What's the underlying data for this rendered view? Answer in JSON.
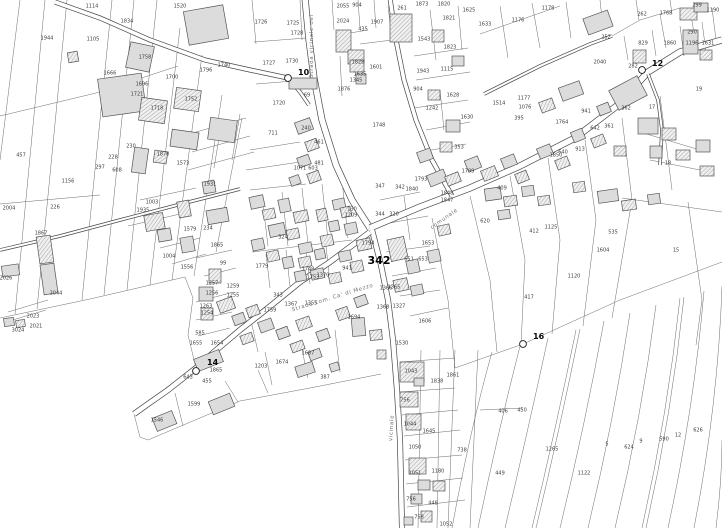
{
  "map": {
    "type": "cadastral-parcel-map",
    "colors": {
      "background": "#ffffff",
      "parcel_line": "#6b6b6b",
      "road_edge": "#474747",
      "building_fill": "#dcdcdc",
      "building_stroke": "#555555",
      "hatch_line": "#929292",
      "label_text": "#3d3d3d",
      "street_text": "#6f6f6f",
      "point_text": "#0a0a0a"
    },
    "highlight_parcel": {
      "label": "342",
      "x": 379,
      "y": 261
    },
    "survey_points": [
      {
        "id": "10",
        "x": 288,
        "y": 78,
        "lx": 298,
        "ly": 75
      },
      {
        "id": "12",
        "x": 642,
        "y": 70,
        "lx": 652,
        "ly": 66
      },
      {
        "id": "14",
        "x": 196,
        "y": 371,
        "lx": 207,
        "ly": 365
      },
      {
        "id": "16",
        "x": 523,
        "y": 344,
        "lx": 533,
        "ly": 339
      }
    ],
    "street_labels": [
      {
        "text": "Strada vicinale del",
        "x": 313,
        "y": 46,
        "rotation": -90
      },
      {
        "text": "Strada com. Ca' di Mezzo",
        "x": 333,
        "y": 299,
        "rotation": -17
      },
      {
        "text": "comunale",
        "x": 445,
        "y": 220,
        "rotation": -35
      },
      {
        "text": "vicinale",
        "x": 393,
        "y": 428,
        "rotation": -87
      }
    ],
    "parcel_labels": [
      {
        "t": "1114",
        "x": 92,
        "y": 6
      },
      {
        "t": "1834",
        "x": 127,
        "y": 21
      },
      {
        "t": "1944",
        "x": 47,
        "y": 38
      },
      {
        "t": "1105",
        "x": 93,
        "y": 39
      },
      {
        "t": "1520",
        "x": 180,
        "y": 6
      },
      {
        "t": "1758",
        "x": 145,
        "y": 57
      },
      {
        "t": "1666",
        "x": 110,
        "y": 73
      },
      {
        "t": "1700",
        "x": 172,
        "y": 77
      },
      {
        "t": "1696",
        "x": 142,
        "y": 84
      },
      {
        "t": "1721",
        "x": 137,
        "y": 94
      },
      {
        "t": "1740",
        "x": 224,
        "y": 65
      },
      {
        "t": "1796",
        "x": 206,
        "y": 70
      },
      {
        "t": "1718",
        "x": 157,
        "y": 108
      },
      {
        "t": "1752",
        "x": 191,
        "y": 99
      },
      {
        "t": "230",
        "x": 131,
        "y": 146
      },
      {
        "t": "228",
        "x": 113,
        "y": 157
      },
      {
        "t": "297",
        "x": 100,
        "y": 167
      },
      {
        "t": "608",
        "x": 117,
        "y": 170
      },
      {
        "t": "457",
        "x": 21,
        "y": 155
      },
      {
        "t": "1573",
        "x": 183,
        "y": 163
      },
      {
        "t": "1878",
        "x": 163,
        "y": 154
      },
      {
        "t": "1156",
        "x": 68,
        "y": 181
      },
      {
        "t": "226",
        "x": 55,
        "y": 207
      },
      {
        "t": "2004",
        "x": 9,
        "y": 208
      },
      {
        "t": "1867",
        "x": 41,
        "y": 233
      },
      {
        "t": "2026",
        "x": 6,
        "y": 278
      },
      {
        "t": "2044",
        "x": 56,
        "y": 293
      },
      {
        "t": "2023",
        "x": 33,
        "y": 316
      },
      {
        "t": "2021",
        "x": 36,
        "y": 326
      },
      {
        "t": "3024",
        "x": 18,
        "y": 330
      },
      {
        "t": "1003",
        "x": 152,
        "y": 202
      },
      {
        "t": "1935",
        "x": 143,
        "y": 210
      },
      {
        "t": "1931",
        "x": 210,
        "y": 184
      },
      {
        "t": "1579",
        "x": 190,
        "y": 229
      },
      {
        "t": "234",
        "x": 208,
        "y": 228
      },
      {
        "t": "1004",
        "x": 169,
        "y": 256
      },
      {
        "t": "1556",
        "x": 187,
        "y": 267
      },
      {
        "t": "1865",
        "x": 217,
        "y": 245
      },
      {
        "t": "99",
        "x": 223,
        "y": 263
      },
      {
        "t": "1257",
        "x": 212,
        "y": 283
      },
      {
        "t": "1256",
        "x": 212,
        "y": 293
      },
      {
        "t": "1263",
        "x": 206,
        "y": 306
      },
      {
        "t": "1254",
        "x": 207,
        "y": 313
      },
      {
        "t": "1259",
        "x": 233,
        "y": 286
      },
      {
        "t": "1255",
        "x": 233,
        "y": 295
      },
      {
        "t": "585",
        "x": 200,
        "y": 333
      },
      {
        "t": "1655",
        "x": 196,
        "y": 343
      },
      {
        "t": "1654",
        "x": 217,
        "y": 343
      },
      {
        "t": "1726",
        "x": 261,
        "y": 22
      },
      {
        "t": "1725",
        "x": 293,
        "y": 23
      },
      {
        "t": "1728",
        "x": 297,
        "y": 33
      },
      {
        "t": "1727",
        "x": 269,
        "y": 63
      },
      {
        "t": "1730",
        "x": 292,
        "y": 61
      },
      {
        "t": "1720",
        "x": 279,
        "y": 103
      },
      {
        "t": "69",
        "x": 307,
        "y": 95
      },
      {
        "t": "240",
        "x": 306,
        "y": 128
      },
      {
        "t": "711",
        "x": 273,
        "y": 133
      },
      {
        "t": "2055",
        "x": 343,
        "y": 6
      },
      {
        "t": "2024",
        "x": 343,
        "y": 21
      },
      {
        "t": "904",
        "x": 357,
        "y": 5
      },
      {
        "t": "1907",
        "x": 377,
        "y": 22
      },
      {
        "t": "435",
        "x": 363,
        "y": 29
      },
      {
        "t": "1828",
        "x": 358,
        "y": 62
      },
      {
        "t": "1635",
        "x": 360,
        "y": 74
      },
      {
        "t": "1601",
        "x": 376,
        "y": 67
      },
      {
        "t": "1345",
        "x": 356,
        "y": 80
      },
      {
        "t": "1876",
        "x": 344,
        "y": 89
      },
      {
        "t": "1748",
        "x": 379,
        "y": 125
      },
      {
        "t": "261",
        "x": 402,
        "y": 8
      },
      {
        "t": "1873",
        "x": 422,
        "y": 4
      },
      {
        "t": "1820",
        "x": 444,
        "y": 4
      },
      {
        "t": "1821",
        "x": 449,
        "y": 18
      },
      {
        "t": "1625",
        "x": 469,
        "y": 10
      },
      {
        "t": "1543",
        "x": 424,
        "y": 39
      },
      {
        "t": "1823",
        "x": 450,
        "y": 47
      },
      {
        "t": "1943",
        "x": 423,
        "y": 71
      },
      {
        "t": "1115",
        "x": 447,
        "y": 69
      },
      {
        "t": "904",
        "x": 418,
        "y": 89
      },
      {
        "t": "1628",
        "x": 453,
        "y": 95
      },
      {
        "t": "1242",
        "x": 432,
        "y": 108
      },
      {
        "t": "1630",
        "x": 467,
        "y": 117
      },
      {
        "t": "353",
        "x": 459,
        "y": 147
      },
      {
        "t": "1799",
        "x": 468,
        "y": 171
      },
      {
        "t": "461",
        "x": 319,
        "y": 142
      },
      {
        "t": "481",
        "x": 319,
        "y": 163
      },
      {
        "t": "1071",
        "x": 300,
        "y": 168
      },
      {
        "t": "603",
        "x": 313,
        "y": 168
      },
      {
        "t": "1178",
        "x": 548,
        "y": 8
      },
      {
        "t": "1176",
        "x": 518,
        "y": 20
      },
      {
        "t": "1633",
        "x": 485,
        "y": 24
      },
      {
        "t": "252",
        "x": 606,
        "y": 37
      },
      {
        "t": "262",
        "x": 642,
        "y": 14
      },
      {
        "t": "1768",
        "x": 666,
        "y": 13
      },
      {
        "t": "299",
        "x": 697,
        "y": 5
      },
      {
        "t": "1190",
        "x": 713,
        "y": 10
      },
      {
        "t": "290",
        "x": 692,
        "y": 32
      },
      {
        "t": "829",
        "x": 643,
        "y": 43
      },
      {
        "t": "1860",
        "x": 670,
        "y": 43
      },
      {
        "t": "1196",
        "x": 692,
        "y": 43
      },
      {
        "t": "1631",
        "x": 708,
        "y": 43
      },
      {
        "t": "2040",
        "x": 600,
        "y": 62
      },
      {
        "t": "282",
        "x": 633,
        "y": 66
      },
      {
        "t": "19",
        "x": 699,
        "y": 89
      },
      {
        "t": "17",
        "x": 652,
        "y": 107
      },
      {
        "t": "362",
        "x": 626,
        "y": 108
      },
      {
        "t": "361",
        "x": 609,
        "y": 126
      },
      {
        "t": "1177",
        "x": 524,
        "y": 98
      },
      {
        "t": "1076",
        "x": 525,
        "y": 107
      },
      {
        "t": "395",
        "x": 519,
        "y": 118
      },
      {
        "t": "1514",
        "x": 499,
        "y": 103
      },
      {
        "t": "1764",
        "x": 562,
        "y": 122
      },
      {
        "t": "941",
        "x": 586,
        "y": 111
      },
      {
        "t": "642",
        "x": 595,
        "y": 128
      },
      {
        "t": "913",
        "x": 580,
        "y": 149
      },
      {
        "t": "640",
        "x": 563,
        "y": 152
      },
      {
        "t": "1850",
        "x": 556,
        "y": 155
      },
      {
        "t": "18",
        "x": 668,
        "y": 163
      },
      {
        "t": "324",
        "x": 283,
        "y": 237
      },
      {
        "t": "1779",
        "x": 262,
        "y": 266
      },
      {
        "t": "343",
        "x": 278,
        "y": 295
      },
      {
        "t": "1367",
        "x": 291,
        "y": 304
      },
      {
        "t": "1759",
        "x": 270,
        "y": 310
      },
      {
        "t": "1355",
        "x": 311,
        "y": 303
      },
      {
        "t": "1694",
        "x": 354,
        "y": 317
      },
      {
        "t": "1687",
        "x": 308,
        "y": 353
      },
      {
        "t": "1530",
        "x": 402,
        "y": 343
      },
      {
        "t": "1606",
        "x": 425,
        "y": 321
      },
      {
        "t": "1653",
        "x": 428,
        "y": 243
      },
      {
        "t": "1365",
        "x": 394,
        "y": 287
      },
      {
        "t": "1366",
        "x": 386,
        "y": 288
      },
      {
        "t": "320",
        "x": 394,
        "y": 214
      },
      {
        "t": "344",
        "x": 380,
        "y": 214
      },
      {
        "t": "347",
        "x": 380,
        "y": 186
      },
      {
        "t": "342",
        "x": 400,
        "y": 187
      },
      {
        "t": "1794",
        "x": 368,
        "y": 243
      },
      {
        "t": "941",
        "x": 347,
        "y": 268
      },
      {
        "t": "1748",
        "x": 308,
        "y": 269
      },
      {
        "t": "1753",
        "x": 313,
        "y": 277
      },
      {
        "t": "1370",
        "x": 323,
        "y": 275
      },
      {
        "t": "651",
        "x": 409,
        "y": 259
      },
      {
        "t": "653",
        "x": 423,
        "y": 259
      },
      {
        "t": "1848",
        "x": 447,
        "y": 193
      },
      {
        "t": "1847",
        "x": 447,
        "y": 200
      },
      {
        "t": "1368",
        "x": 383,
        "y": 307
      },
      {
        "t": "1327",
        "x": 399,
        "y": 306
      },
      {
        "t": "130",
        "x": 352,
        "y": 209
      },
      {
        "t": "1209",
        "x": 351,
        "y": 215
      },
      {
        "t": "1793",
        "x": 421,
        "y": 179
      },
      {
        "t": "1840",
        "x": 412,
        "y": 189
      },
      {
        "t": "409",
        "x": 502,
        "y": 188
      },
      {
        "t": "1125",
        "x": 551,
        "y": 227
      },
      {
        "t": "535",
        "x": 613,
        "y": 232
      },
      {
        "t": "1604",
        "x": 603,
        "y": 250
      },
      {
        "t": "15",
        "x": 676,
        "y": 250
      },
      {
        "t": "1120",
        "x": 574,
        "y": 276
      },
      {
        "t": "417",
        "x": 529,
        "y": 297
      },
      {
        "t": "620",
        "x": 485,
        "y": 221
      },
      {
        "t": "412",
        "x": 534,
        "y": 231
      },
      {
        "t": "1203",
        "x": 261,
        "y": 366
      },
      {
        "t": "1674",
        "x": 282,
        "y": 362
      },
      {
        "t": "387",
        "x": 325,
        "y": 377
      },
      {
        "t": "1043",
        "x": 411,
        "y": 371
      },
      {
        "t": "1838",
        "x": 437,
        "y": 381
      },
      {
        "t": "1861",
        "x": 453,
        "y": 375
      },
      {
        "t": "756",
        "x": 405,
        "y": 400
      },
      {
        "t": "1044",
        "x": 410,
        "y": 424
      },
      {
        "t": "1645",
        "x": 429,
        "y": 431
      },
      {
        "t": "1050",
        "x": 415,
        "y": 447
      },
      {
        "t": "1051",
        "x": 415,
        "y": 473
      },
      {
        "t": "1180",
        "x": 438,
        "y": 471
      },
      {
        "t": "756",
        "x": 411,
        "y": 499
      },
      {
        "t": "448",
        "x": 433,
        "y": 503
      },
      {
        "t": "758",
        "x": 419,
        "y": 517
      },
      {
        "t": "738",
        "x": 462,
        "y": 450
      },
      {
        "t": "1052",
        "x": 446,
        "y": 524
      },
      {
        "t": "643",
        "x": 188,
        "y": 377
      },
      {
        "t": "1599",
        "x": 194,
        "y": 404
      },
      {
        "t": "1546",
        "x": 157,
        "y": 420
      },
      {
        "t": "1865",
        "x": 216,
        "y": 370
      },
      {
        "t": "455",
        "x": 207,
        "y": 381
      },
      {
        "t": "406",
        "x": 503,
        "y": 411
      },
      {
        "t": "450",
        "x": 522,
        "y": 410
      },
      {
        "t": "1265",
        "x": 552,
        "y": 449
      },
      {
        "t": "449",
        "x": 500,
        "y": 473
      },
      {
        "t": "1122",
        "x": 584,
        "y": 473
      },
      {
        "t": "5",
        "x": 607,
        "y": 444
      },
      {
        "t": "624",
        "x": 629,
        "y": 447
      },
      {
        "t": "9",
        "x": 641,
        "y": 441
      },
      {
        "t": "590",
        "x": 664,
        "y": 439
      },
      {
        "t": "12",
        "x": 678,
        "y": 435
      },
      {
        "t": "626",
        "x": 698,
        "y": 430
      }
    ]
  }
}
